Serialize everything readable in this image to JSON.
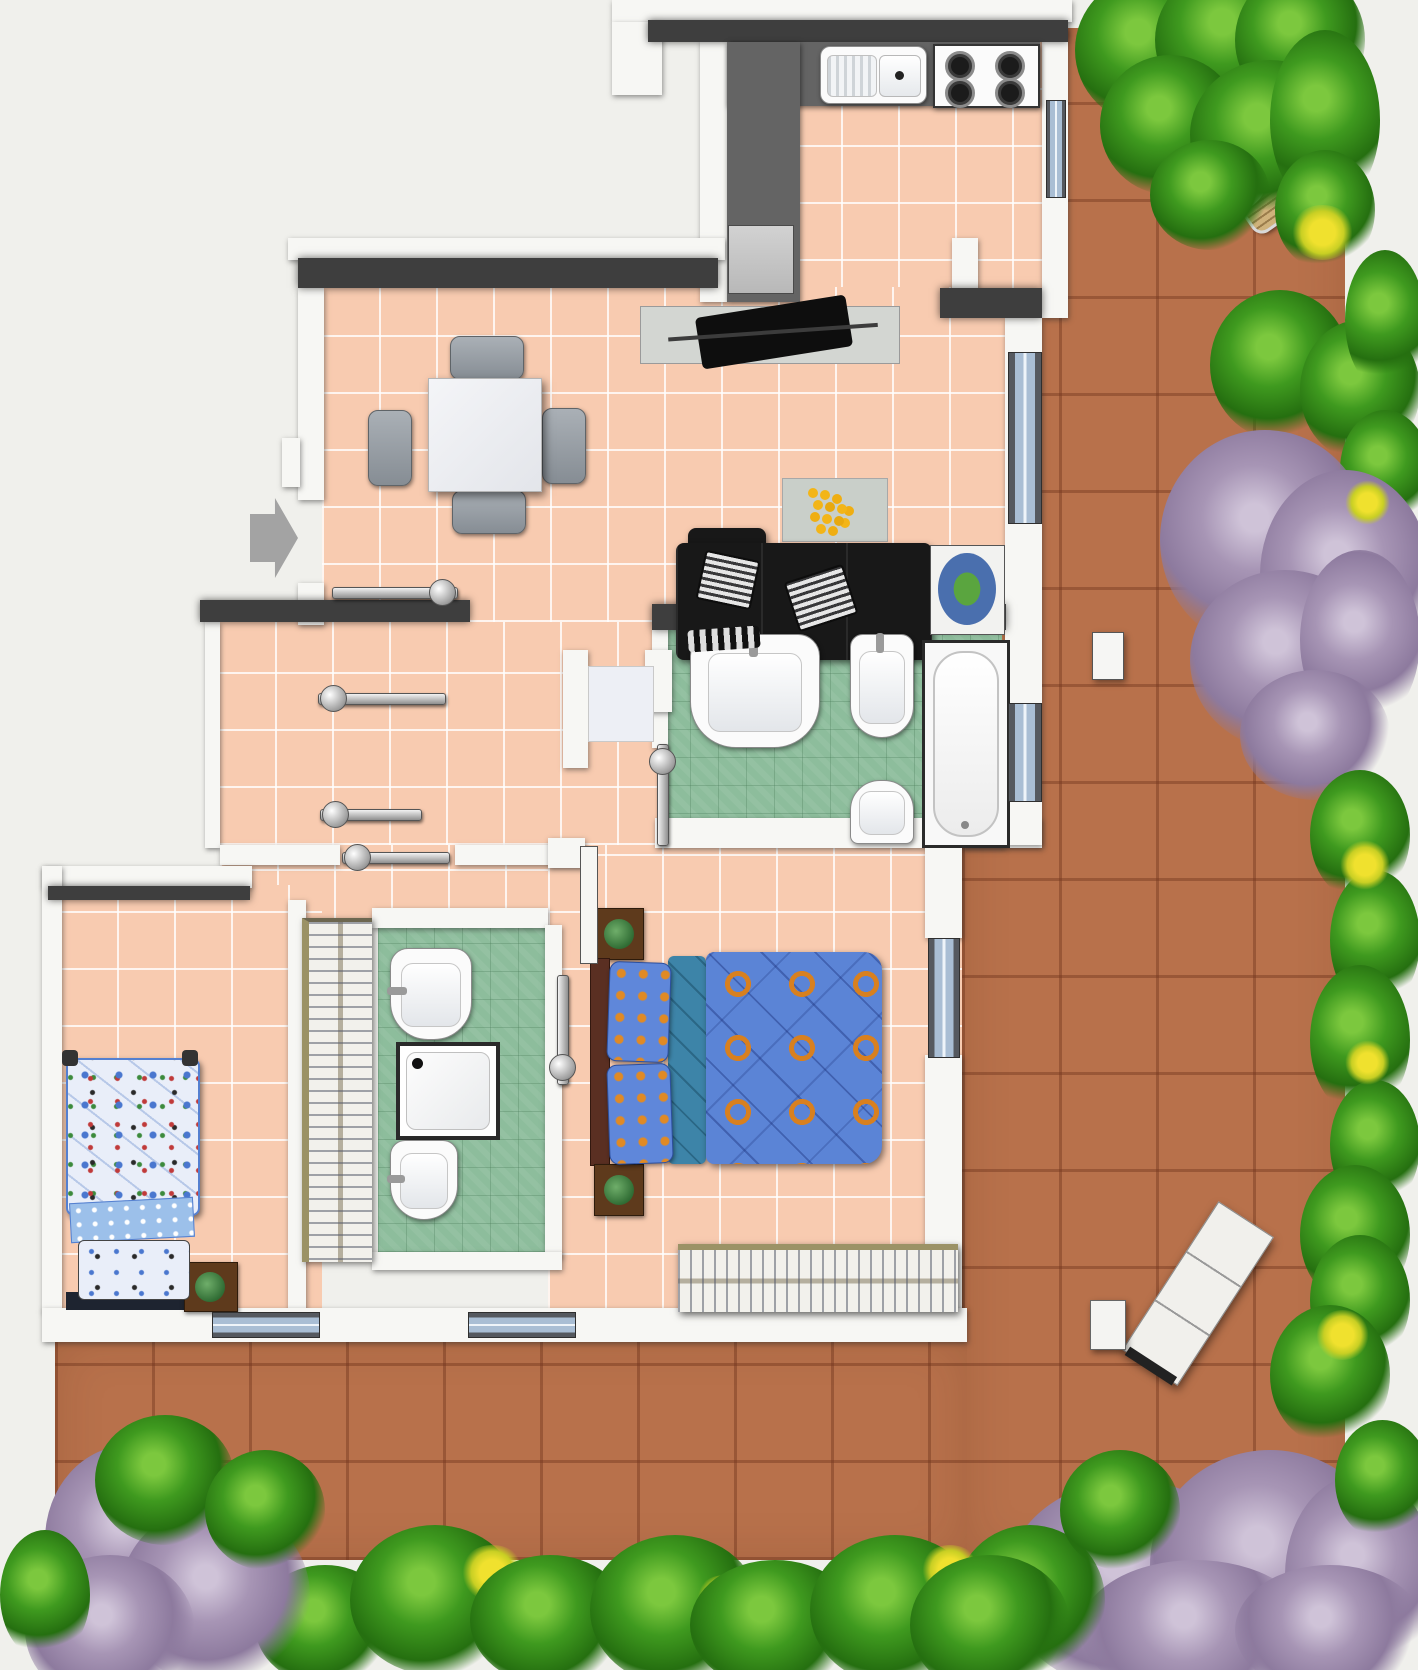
{
  "title": "Apartment floor plan with wrap-around terracotta terrace",
  "colors": {
    "background": "#f0f0ec",
    "interior_tile": "#f8cbb0",
    "bathroom_tile": "#8dbd9c",
    "terrace_tile": "#b8714b",
    "wall": "#f7f7f4",
    "wall_shadow": "#3e3e3e",
    "kitchen_counter": "#646464",
    "sofa": "#181818",
    "bed_duvet_blue": "#5b84d6",
    "bed_ring_orange": "#d8801f",
    "greenery": "#3f9a1f",
    "flowers_yellow": "#f0e12e",
    "lilac_tree": "#a795b5"
  },
  "entry": {
    "symbol": "gray-arrow",
    "direction": "right"
  },
  "rooms": [
    {
      "name": "kitchen",
      "floor": "pink-tile",
      "fixtures": [
        "counter-L",
        "double-sink",
        "stove-4-burner",
        "appliance"
      ]
    },
    {
      "name": "living-dining-room",
      "floor": "pink-tile",
      "furniture": [
        "square-dining-table",
        "dining-chairs-x4",
        "sideboard",
        "tv-unit",
        "black-sofa",
        "sunflower-rug",
        "oval-rug"
      ]
    },
    {
      "name": "main-bathroom",
      "floor": "green-tile",
      "fixtures": [
        "washbasin",
        "bidet",
        "toilet",
        "bathtub"
      ],
      "doors": [
        "sliding-door"
      ]
    },
    {
      "name": "hallway",
      "floor": "pink-tile",
      "features": [
        "sliding-doors-x4",
        "floor-mat"
      ]
    },
    {
      "name": "kids-bedroom",
      "floor": "pink-tile",
      "furniture": [
        "single-bed-patterned",
        "nightstand-with-plant"
      ]
    },
    {
      "name": "second-bathroom",
      "floor": "green-tile",
      "fixtures": [
        "washbasin",
        "shower-tray",
        "bidet"
      ],
      "doors": [
        "sliding-door"
      ]
    },
    {
      "name": "master-bedroom",
      "floor": "pink-tile",
      "furniture": [
        "double-bed-blue-orange-rings",
        "nightstand-with-plant-x2",
        "wardrobe-hanger-rack"
      ],
      "doors": [
        "terrace-glass-door",
        "swing-door-leaf"
      ]
    },
    {
      "name": "wardrobe-closet",
      "floor": "none",
      "furniture": [
        "hanger-rack-vertical"
      ]
    }
  ],
  "outdoor": {
    "terrace_shape": "L-shaped right and bottom",
    "furniture": [
      "round-bistro-table",
      "wooden-chairs-x3",
      "sun-lounger-3-panel",
      "side-table",
      "planter-box"
    ],
    "vegetation": [
      "green-bushes",
      "yellow-flower-patches",
      "lilac-trees"
    ]
  },
  "windows": [
    "kitchen-right",
    "living-sliding-door",
    "bathroom-right",
    "bedroom-terrace-door",
    "bottom-wall-x2"
  ]
}
